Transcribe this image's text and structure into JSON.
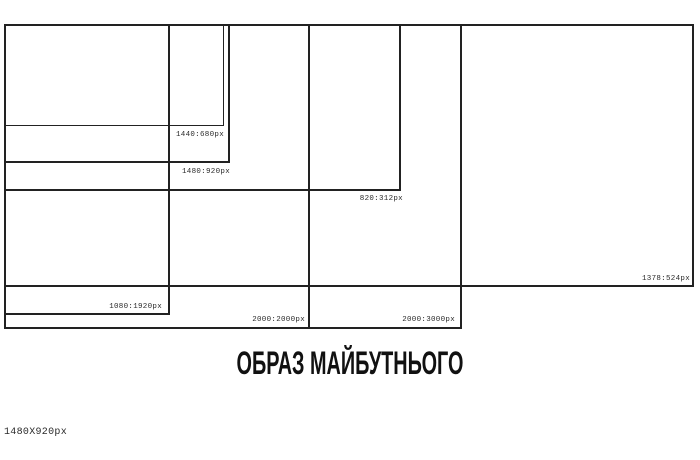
{
  "diagram": {
    "background": "#ffffff",
    "line_color": "#222222",
    "frames": [
      {
        "label": "1440:680px"
      },
      {
        "label": "1480:920px"
      },
      {
        "label": "820:312px"
      },
      {
        "label": "1080:1920px"
      },
      {
        "label": "2000:2000px"
      },
      {
        "label": "2000:3000px"
      },
      {
        "label": "1378:524px"
      }
    ],
    "title": "ОБРАЗ МАЙБУТНЬОГО",
    "canvas_size_label": "1480X920px"
  }
}
